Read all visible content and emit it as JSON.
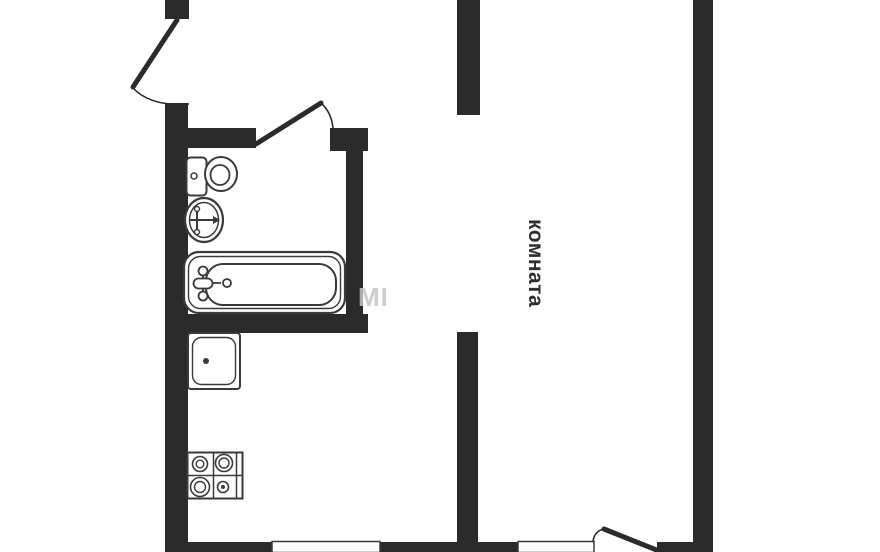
{
  "document": {
    "type": "apartment-floor-plan"
  },
  "labels": {
    "room": "комната",
    "watermark": "MI"
  },
  "colors": {
    "background": "#ffffff",
    "wall": "#2b2b2b",
    "fixture_stroke": "#3a3a3a",
    "door_stroke": "#2b2b2b",
    "room_label": "#2e2e2e",
    "watermark": "#c5c5c5"
  },
  "rooms": [
    {
      "name": "bathroom",
      "fixtures": [
        "toilet",
        "wash-basin",
        "bathtub"
      ]
    },
    {
      "name": "kitchen",
      "fixtures": [
        "kitchen-sink",
        "stove-4-burners"
      ]
    },
    {
      "name": "living-room",
      "label": "комната"
    }
  ],
  "doors": [
    {
      "name": "entrance-door",
      "location": "top-left-wall"
    },
    {
      "name": "bathroom-door",
      "location": "bathroom-top-wall"
    },
    {
      "name": "room-door",
      "location": "bottom-right-wall"
    }
  ]
}
